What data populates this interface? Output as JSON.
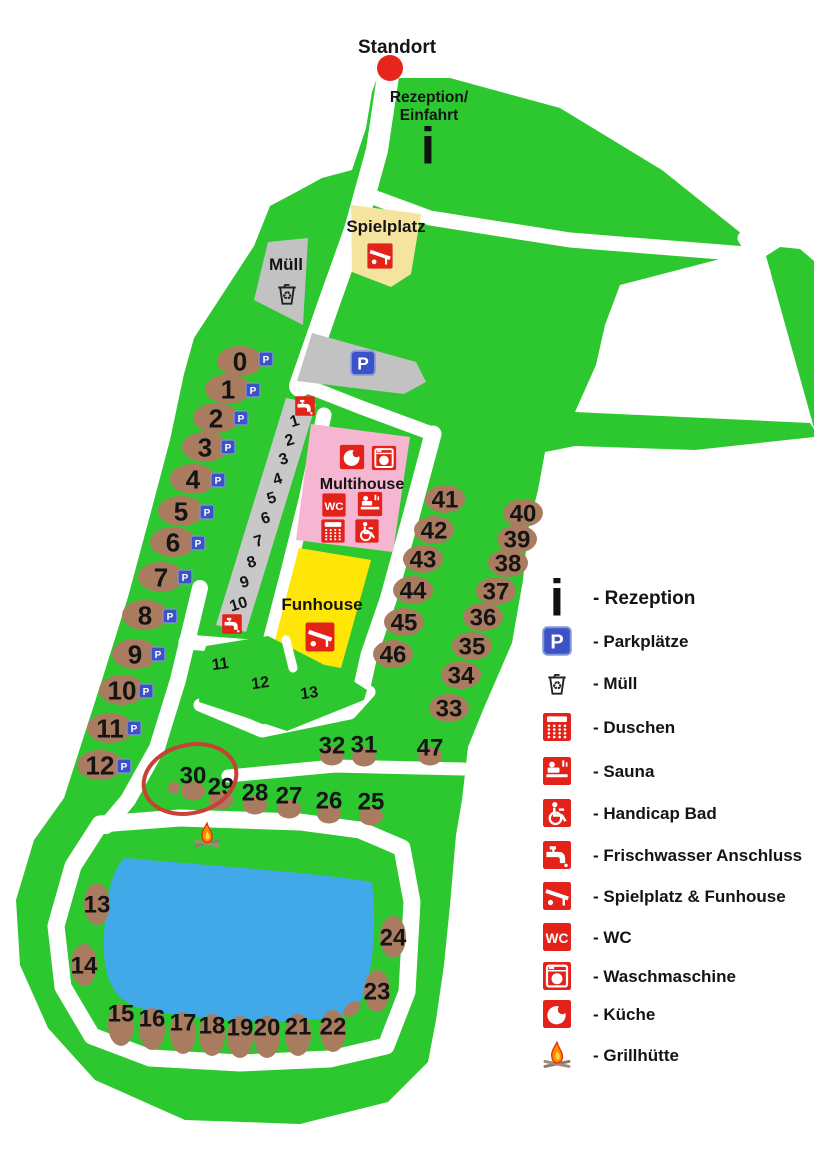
{
  "standort": {
    "label": "Standort"
  },
  "reception": {
    "line1": "Rezeption/",
    "line2": "Einfahrt"
  },
  "areas": {
    "spielplatz": "Spielplatz",
    "muell": "Müll",
    "multihouse": "Multihouse",
    "funhouse": "Funhouse"
  },
  "map": {
    "sites": [
      {
        "n": "0",
        "x": 240,
        "y": 361,
        "s": "h",
        "p": [
          266,
          359
        ]
      },
      {
        "n": "1",
        "x": 228,
        "y": 389,
        "s": "h",
        "p": [
          253,
          390
        ]
      },
      {
        "n": "2",
        "x": 216,
        "y": 418,
        "s": "h",
        "p": [
          241,
          418
        ]
      },
      {
        "n": "3",
        "x": 205,
        "y": 447,
        "s": "h",
        "p": [
          228,
          447
        ]
      },
      {
        "n": "4",
        "x": 193,
        "y": 479,
        "s": "h",
        "p": [
          218,
          480
        ]
      },
      {
        "n": "5",
        "x": 181,
        "y": 511,
        "s": "h",
        "p": [
          207,
          512
        ]
      },
      {
        "n": "6",
        "x": 173,
        "y": 542,
        "s": "h",
        "p": [
          198,
          543
        ]
      },
      {
        "n": "7",
        "x": 161,
        "y": 577,
        "s": "h",
        "p": [
          185,
          577
        ]
      },
      {
        "n": "8",
        "x": 145,
        "y": 615,
        "s": "h",
        "p": [
          170,
          616
        ]
      },
      {
        "n": "9",
        "x": 135,
        "y": 654,
        "s": "h",
        "p": [
          158,
          654
        ]
      },
      {
        "n": "10",
        "x": 122,
        "y": 690,
        "s": "h",
        "p": [
          146,
          691
        ]
      },
      {
        "n": "11",
        "x": 110,
        "y": 728,
        "s": "h",
        "p": [
          134,
          728
        ]
      },
      {
        "n": "12",
        "x": 100,
        "y": 765,
        "s": "h",
        "p": [
          124,
          766
        ]
      },
      {
        "n": "13",
        "x": 97,
        "y": 904,
        "s": "v"
      },
      {
        "n": "14",
        "x": 84,
        "y": 965,
        "s": "v"
      },
      {
        "n": "15",
        "x": 121,
        "y": 1025,
        "s": "v",
        "dy": -12
      },
      {
        "n": "16",
        "x": 152,
        "y": 1029,
        "s": "v",
        "dy": -11
      },
      {
        "n": "17",
        "x": 183,
        "y": 1033,
        "s": "v",
        "dy": -11
      },
      {
        "n": "18",
        "x": 212,
        "y": 1035,
        "s": "v",
        "dy": -10
      },
      {
        "n": "19",
        "x": 240,
        "y": 1037,
        "s": "v",
        "dy": -10
      },
      {
        "n": "20",
        "x": 267,
        "y": 1037,
        "s": "v",
        "dy": -10
      },
      {
        "n": "21",
        "x": 298,
        "y": 1035,
        "s": "v",
        "dy": -9
      },
      {
        "n": "22",
        "x": 333,
        "y": 1031,
        "s": "v",
        "dy": -5
      },
      {
        "n": "23",
        "x": 377,
        "y": 991,
        "s": "v"
      },
      {
        "n": "24",
        "x": 393,
        "y": 937,
        "s": "v"
      },
      {
        "n": "25",
        "x": 371,
        "y": 816,
        "s": "m",
        "dy": -15
      },
      {
        "n": "26",
        "x": 329,
        "y": 814,
        "s": "m",
        "dy": -14
      },
      {
        "n": "27",
        "x": 289,
        "y": 809,
        "s": "m",
        "dy": -14
      },
      {
        "n": "28",
        "x": 255,
        "y": 805,
        "s": "m",
        "dy": -13
      },
      {
        "n": "29",
        "x": 221,
        "y": 800,
        "s": "m",
        "dy": -14
      },
      {
        "n": "30",
        "x": 193,
        "y": 791,
        "s": "m",
        "dy": -16
      },
      {
        "n": "31",
        "x": 364,
        "y": 757,
        "s": "m",
        "dy": -13
      },
      {
        "n": "32",
        "x": 332,
        "y": 756,
        "s": "m",
        "dy": -11
      },
      {
        "n": "33",
        "x": 449,
        "y": 708,
        "s": "h2"
      },
      {
        "n": "34",
        "x": 461,
        "y": 675,
        "s": "h2"
      },
      {
        "n": "35",
        "x": 472,
        "y": 646,
        "s": "h2"
      },
      {
        "n": "36",
        "x": 483,
        "y": 617,
        "s": "h2"
      },
      {
        "n": "37",
        "x": 496,
        "y": 591,
        "s": "h2"
      },
      {
        "n": "38",
        "x": 508,
        "y": 563,
        "s": "h2"
      },
      {
        "n": "39",
        "x": 517,
        "y": 539,
        "s": "h2"
      },
      {
        "n": "40",
        "x": 523,
        "y": 513,
        "s": "h2"
      },
      {
        "n": "41",
        "x": 445,
        "y": 499,
        "s": "h2"
      },
      {
        "n": "42",
        "x": 434,
        "y": 530,
        "s": "h2"
      },
      {
        "n": "43",
        "x": 423,
        "y": 559,
        "s": "h2"
      },
      {
        "n": "44",
        "x": 413,
        "y": 590,
        "s": "h2"
      },
      {
        "n": "45",
        "x": 404,
        "y": 622,
        "s": "h2"
      },
      {
        "n": "46",
        "x": 393,
        "y": 654,
        "s": "h2"
      },
      {
        "n": "47",
        "x": 430,
        "y": 756,
        "s": "m",
        "dy": -9
      }
    ],
    "lanes": [
      {
        "n": "1",
        "x": 296,
        "y": 426
      },
      {
        "n": "2",
        "x": 291,
        "y": 445
      },
      {
        "n": "3",
        "x": 285,
        "y": 464
      },
      {
        "n": "4",
        "x": 279,
        "y": 484
      },
      {
        "n": "5",
        "x": 273,
        "y": 503
      },
      {
        "n": "6",
        "x": 267,
        "y": 523
      },
      {
        "n": "7",
        "x": 260,
        "y": 546
      },
      {
        "n": "8",
        "x": 253,
        "y": 567
      },
      {
        "n": "9",
        "x": 246,
        "y": 587
      },
      {
        "n": "10",
        "x": 240,
        "y": 609
      }
    ],
    "zones": [
      {
        "n": "11",
        "x": 221,
        "y": 669
      },
      {
        "n": "12",
        "x": 261,
        "y": 688
      },
      {
        "n": "13",
        "x": 310,
        "y": 698
      }
    ],
    "taps": [
      {
        "x": 305,
        "y": 406
      },
      {
        "x": 232,
        "y": 624
      }
    ],
    "fire": {
      "x": 207,
      "y": 835
    },
    "highlight": {
      "x": 190,
      "y": 779,
      "rx": 47,
      "ry": 34,
      "rot": -14
    }
  },
  "legend": {
    "items": [
      {
        "icon": "info-icon",
        "label": "- Rezeption"
      },
      {
        "icon": "parking-icon",
        "label": "- Parkplätze"
      },
      {
        "icon": "trash-icon",
        "label": "- Müll"
      },
      {
        "icon": "shower-icon",
        "label": "- Duschen"
      },
      {
        "icon": "sauna-icon",
        "label": "- Sauna"
      },
      {
        "icon": "handicap-icon",
        "label": "- Handicap Bad"
      },
      {
        "icon": "tap-icon",
        "label": "- Frischwasser Anschluss"
      },
      {
        "icon": "slide-icon",
        "label": "- Spielplatz & Funhouse"
      },
      {
        "icon": "wc-icon",
        "label": "- WC"
      },
      {
        "icon": "washer-icon",
        "label": "- Waschmaschine"
      },
      {
        "icon": "kitchen-icon",
        "label": "- Küche"
      },
      {
        "icon": "fire-icon",
        "label": "- Grillhütte"
      }
    ]
  },
  "colors": {
    "green": "#2DC82F",
    "road": "#FFFFFF",
    "brown": "#A97C5F",
    "gray": "#C2C2C2",
    "pink": "#F6B6D2",
    "yellow": "#FFE607",
    "pale_yellow": "#F5E4A0",
    "lake": "#41A9E8",
    "red": "#E3221A",
    "blue": "#3B53C6",
    "highlight": "#C94034",
    "dot": "#E8251C",
    "text": "#141414"
  }
}
